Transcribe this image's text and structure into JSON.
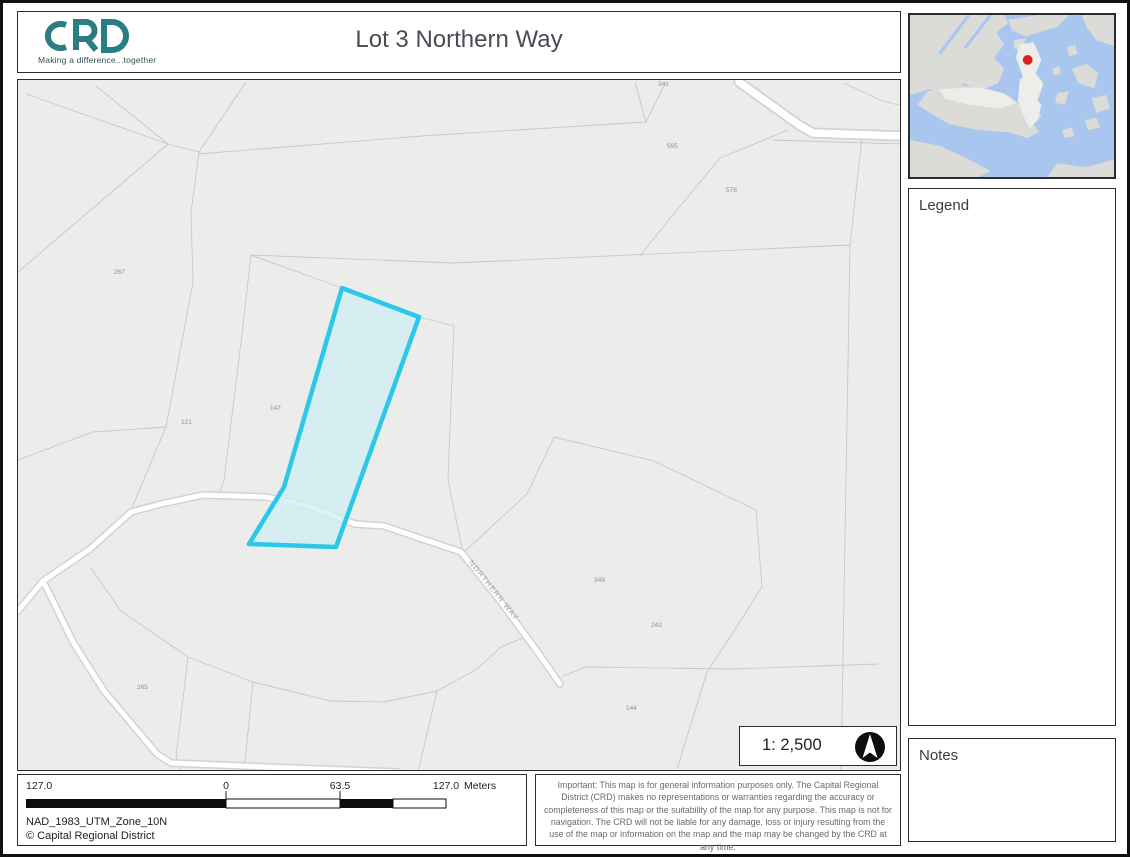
{
  "header": {
    "logo_text": "CRD",
    "logo_tagline": "Making a difference...together",
    "title": "Lot 3 Northern Way"
  },
  "sidebar": {
    "legend_title": "Legend",
    "notes_title": "Notes"
  },
  "inset": {
    "marker_color": "#d92020",
    "water_color": "#a9c7ee",
    "land_color": "#dbdbd8"
  },
  "map": {
    "scale_text": "1: 2,500",
    "street_label": "NORTHERN WAY",
    "highlight_stroke": "#2bc8e9",
    "highlight_fill": "#cfeef4",
    "parcel_labels": [
      {
        "text": "341",
        "x": 640,
        "y": 6
      },
      {
        "text": "595",
        "x": 649,
        "y": 68
      },
      {
        "text": "578",
        "x": 708,
        "y": 112
      },
      {
        "text": "267",
        "x": 96,
        "y": 194
      },
      {
        "text": "147",
        "x": 252,
        "y": 330
      },
      {
        "text": "121",
        "x": 163,
        "y": 344
      },
      {
        "text": "349",
        "x": 576,
        "y": 502
      },
      {
        "text": "242",
        "x": 633,
        "y": 547
      },
      {
        "text": "265",
        "x": 119,
        "y": 609
      },
      {
        "text": "144",
        "x": 608,
        "y": 630
      }
    ]
  },
  "footer": {
    "scalebar": {
      "label_left": "127.0",
      "label_zero": "0",
      "label_mid": "63.5",
      "label_right": "127.0",
      "units": "Meters"
    },
    "projection": "NAD_1983_UTM_Zone_10N",
    "copyright": "© Capital Regional District",
    "disclaimer": "Important: This map is for general information purposes only. The Capital Regional District (CRD) makes no representations or warranties regarding the accuracy or completeness of this map or the suitability of the map for any purpose. This map is not for navigation. The CRD will not be liable for any damage, loss or injury resulting from the use of the map or information on the map and the map may be changed by the CRD at any time."
  }
}
